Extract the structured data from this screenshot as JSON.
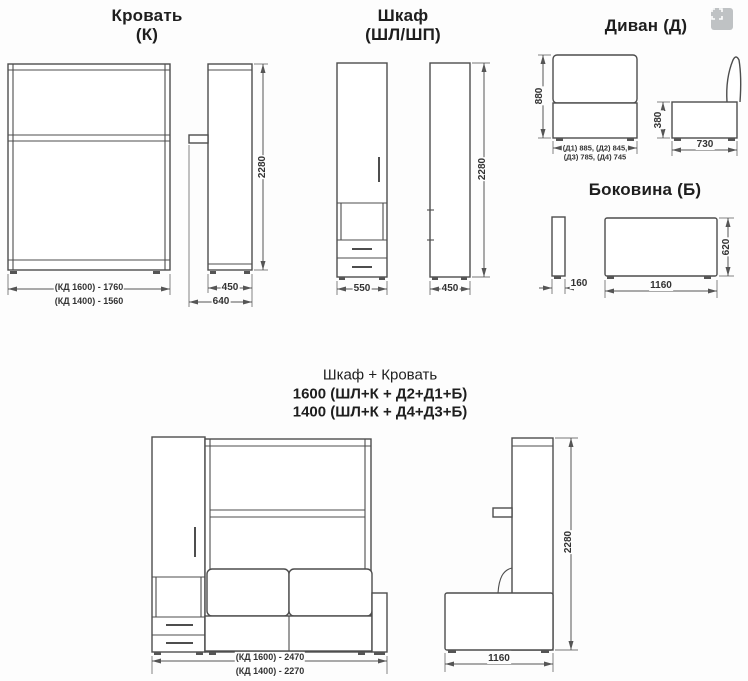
{
  "bed": {
    "title": "Кровать",
    "subtitle": "(К)",
    "height": "2280",
    "width_1600": "(КД 1600) - 1760",
    "width_1400": "(КД 1400) - 1560",
    "depth_inner": "450",
    "depth_outer": "640"
  },
  "wardrobe": {
    "title": "Шкаф",
    "subtitle": "(ШЛ/ШП)",
    "width": "550",
    "depth": "450",
    "height": "2280"
  },
  "sofa": {
    "title": "Диван  (Д)",
    "height": "880",
    "seat_height": "380",
    "depth": "730",
    "widths_line1": "(Д1) 885, (Д2) 845,",
    "widths_line2": "(Д3) 785, (Д4) 745"
  },
  "side_panel": {
    "title": "Боковина (Б)",
    "thickness": "160",
    "width": "1160",
    "height": "620"
  },
  "combo": {
    "title": "Шкаф + Кровать",
    "variant_1600": "1600 (ШЛ+К + Д2+Д1+Б)",
    "variant_1400": "1400 (ШЛ+К + Д4+Д3+Б)",
    "width_1600": "(КД 1600) - 2470",
    "width_1400": "(КД 1400) - 2270",
    "height": "2280",
    "depth": "1160"
  },
  "icons": {
    "fullscreen": "expand-icon"
  },
  "colors": {
    "line": "#4d4d4d",
    "text": "#1e1e1e",
    "dim_text": "#333333",
    "icon_bg": "#b9bcbe"
  }
}
